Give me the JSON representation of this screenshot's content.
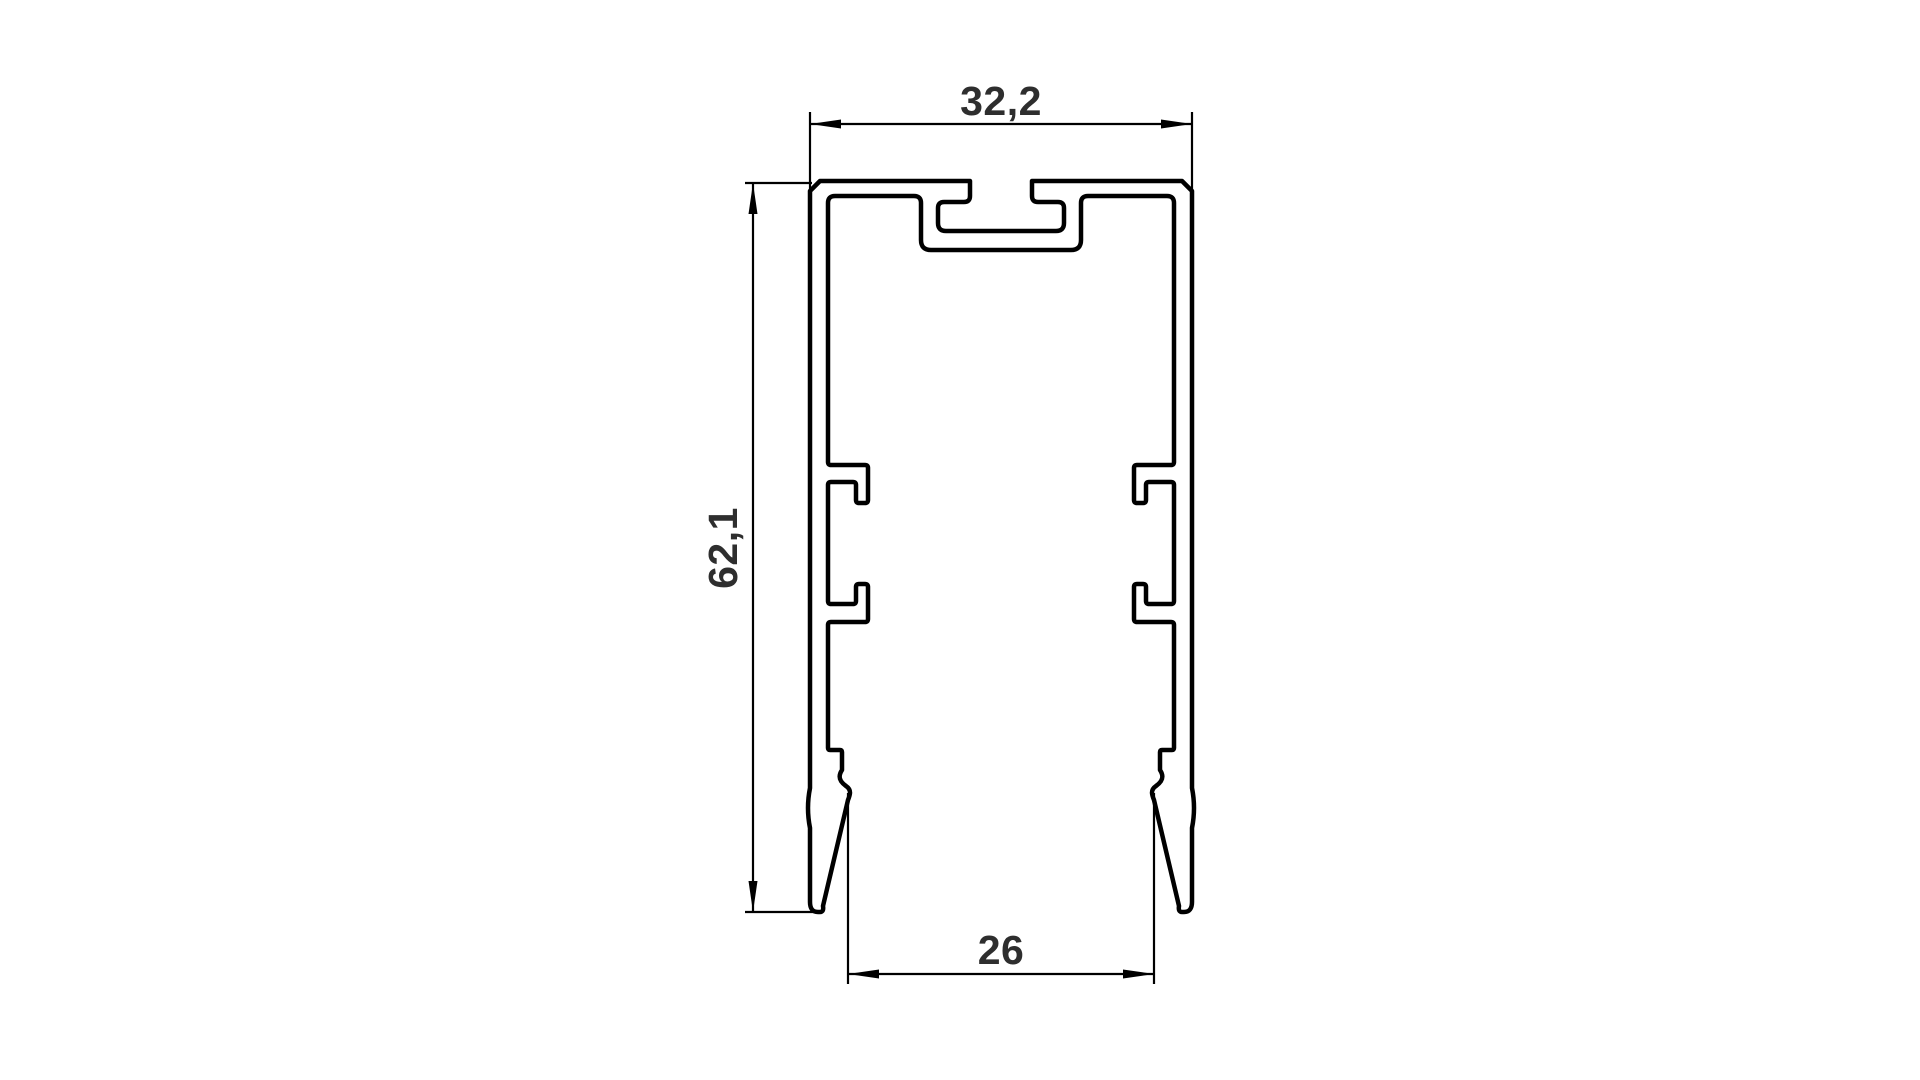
{
  "page": {
    "background_color": "#ffffff",
    "line_color": "#000000",
    "text_color": "#2e2e2e"
  },
  "drawing": {
    "kind": "technical cross-section drawing of an extruded aluminum profile",
    "view": "2D section outline with T-slot top channel, internal snap-fit hooks and two tapered bottom legs",
    "dimensions": {
      "top_width": {
        "label": "32,2",
        "value": 32.2,
        "orientation": "horizontal",
        "position": "top"
      },
      "height": {
        "label": "62,1",
        "value": 62.1,
        "orientation": "vertical",
        "position": "left"
      },
      "bottom_width": {
        "label": "26",
        "value": 26,
        "orientation": "horizontal",
        "position": "bottom"
      }
    }
  }
}
